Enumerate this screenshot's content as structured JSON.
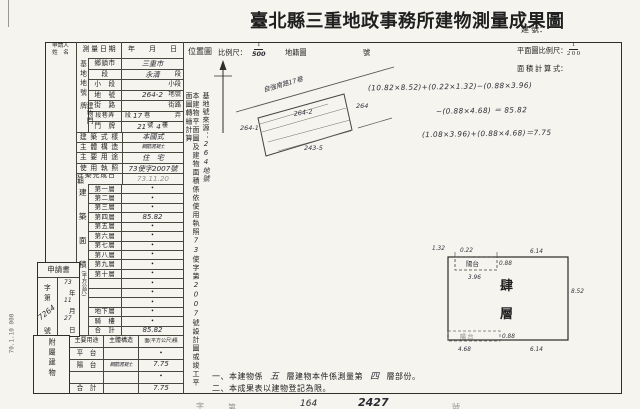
{
  "page": {
    "title": "臺北縣三重地政事務所建物測量成果圖",
    "reg_no_label": "建 號：",
    "print_code": "70.1.10 000"
  },
  "header_row": {
    "applicant_line1": "申請人",
    "applicant_line2": "姓　名",
    "survey_date_label": "測 量 日 期",
    "survey_date_value": "年　　月　　日"
  },
  "location": {
    "label": "位置圖",
    "scale_label": "比例尺：",
    "scale_num": "1",
    "scale_den": "500",
    "cadastral_label": "地籍圖",
    "number_label": "號",
    "road_label": "自強南路17巷",
    "parcel_left": "264-1",
    "parcel_center": "264-2",
    "parcel_right": "264",
    "parcel_bottom": "243-5"
  },
  "plan_header": {
    "scale_label": "平面圖比例尺：",
    "scale_num": "1",
    "scale_den": "2 0 0",
    "calc_label": "面 積 計 算 式：",
    "formula_line1": "(10.82×8.52)+(0.22×1.32)−(0.88×3.96)",
    "formula_line2": "−(0.88×4.68) ＝ 85.82",
    "formula_line3": "(1.08×3.96)+(0.88×4.68)＝7.75"
  },
  "site": {
    "group_label": "基地地號",
    "rows": [
      {
        "label": "鄉鎮市",
        "value": "三重市",
        "suffix": "",
        "cls": "hw"
      },
      {
        "label": "段",
        "value": "永清",
        "suffix": "段",
        "cls": "hw"
      },
      {
        "label": "小　段",
        "value": "",
        "suffix": "小段",
        "cls": ""
      },
      {
        "label": "地　號",
        "value": "264-2",
        "suffix": "地號",
        "cls": "hw"
      }
    ]
  },
  "door": {
    "group_label": "建物門牌",
    "street_label": "街　路",
    "street_suffix": "街路",
    "lane_label": "段巷弄",
    "lane_pre": "段",
    "lane_hw": "17",
    "lane_mid": "巷",
    "lane_suffix": "弄",
    "plate_label": "門　牌",
    "plate_hw1": "21",
    "plate_unit1": "號",
    "plate_hw2": "4",
    "plate_unit2": "樓"
  },
  "info_rows": [
    {
      "label": "建 築 式 樣",
      "value": "本國式",
      "cls": "hw"
    },
    {
      "label": "主 體 構 造",
      "value": "鋼筋混凝土",
      "cls": "hw tiny"
    },
    {
      "label": "主 要 用 途",
      "value": "住　宅",
      "cls": "hw"
    },
    {
      "label": "使 用 執 照",
      "value": "73使字2007號",
      "cls": "hw"
    },
    {
      "label": "建築完成日期",
      "value": "73.11.20",
      "cls": "hw faint"
    }
  ],
  "floor_section": {
    "group_char1": "建",
    "group_char2": "築",
    "group_char3": "面",
    "group_char4": "積",
    "unit_label": "(平方公尺)",
    "rows": [
      {
        "label": "第一層",
        "value": "•",
        "cls": ""
      },
      {
        "label": "第二層",
        "value": "•",
        "cls": ""
      },
      {
        "label": "第三層",
        "value": "•",
        "cls": ""
      },
      {
        "label": "第四層",
        "value": "85.82",
        "cls": "hw"
      },
      {
        "label": "第五層",
        "value": "•",
        "cls": ""
      },
      {
        "label": "第六層",
        "value": "•",
        "cls": ""
      },
      {
        "label": "第七層",
        "value": "•",
        "cls": ""
      },
      {
        "label": "第八層",
        "value": "•",
        "cls": ""
      },
      {
        "label": "第九層",
        "value": "•",
        "cls": ""
      },
      {
        "label": "第十層",
        "value": "•",
        "cls": ""
      },
      {
        "label": "",
        "value": "•",
        "cls": ""
      },
      {
        "label": "",
        "value": "•",
        "cls": ""
      },
      {
        "label": "",
        "value": "•",
        "cls": ""
      },
      {
        "label": "地下層",
        "value": "•",
        "cls": ""
      },
      {
        "label": "騎　樓",
        "value": "•",
        "cls": ""
      },
      {
        "label": "合　計",
        "value": "85.82",
        "cls": "hw"
      }
    ]
  },
  "application": {
    "label": "申請書",
    "zi_label": "字",
    "di_label": "第",
    "no_value": "7264",
    "hao_label": "號",
    "year_hw": "73",
    "year_label": "年",
    "month_hw": "11",
    "month_label": "月",
    "day_hw": "27",
    "day_label": "日"
  },
  "attached": {
    "group_label": "附屬建物",
    "col_use": "主要用途",
    "col_struct": "主體構造",
    "col_area": "面(平方公尺)積",
    "rows": [
      {
        "use": "平　台",
        "struct": "",
        "area": "•",
        "cls": ""
      },
      {
        "use": "陽　台",
        "struct": "鋼筋混凝土",
        "area": "7.75",
        "cls": "hw"
      },
      {
        "use": "",
        "struct": "",
        "area": "•",
        "cls": ""
      },
      {
        "use": "合　計",
        "struct": "",
        "area": "7.75",
        "cls": "hw"
      }
    ]
  },
  "vertical_notes": {
    "source_label": "基地號來源：",
    "source_value": "264地號",
    "basis_prefix": "本建物平面圖及建物面積係依使用執照",
    "basis_no1": "73",
    "basis_mid": "使字第",
    "basis_no2": "2007",
    "basis_suffix": "號設計圖或竣工平面圖轉繪計算"
  },
  "plan": {
    "floor_char1": "肆",
    "floor_char2": "層",
    "balcony_top_label": "陽台",
    "balcony_bottom_label": "陽 台",
    "dims": {
      "d132": "1.32",
      "d022": "0.22",
      "d088_top": "0.88",
      "d396": "3.96",
      "d614_top": "6.14",
      "d852": "8.52",
      "d088_bottom": "0.88",
      "d468": "4.68",
      "d614_bottom": "6.14"
    }
  },
  "footnotes": {
    "n1_pre": "一、本建物係",
    "n1_hw1": "五",
    "n1_mid": "層建物本件係測量第",
    "n1_hw2": "四",
    "n1_post": "層部份。",
    "n2": "二、本成果表以建物登記為限。"
  },
  "footer_fragments": {
    "f1": "字",
    "f2": "第",
    "f3": "164",
    "f4": "2427",
    "f5": "號"
  }
}
